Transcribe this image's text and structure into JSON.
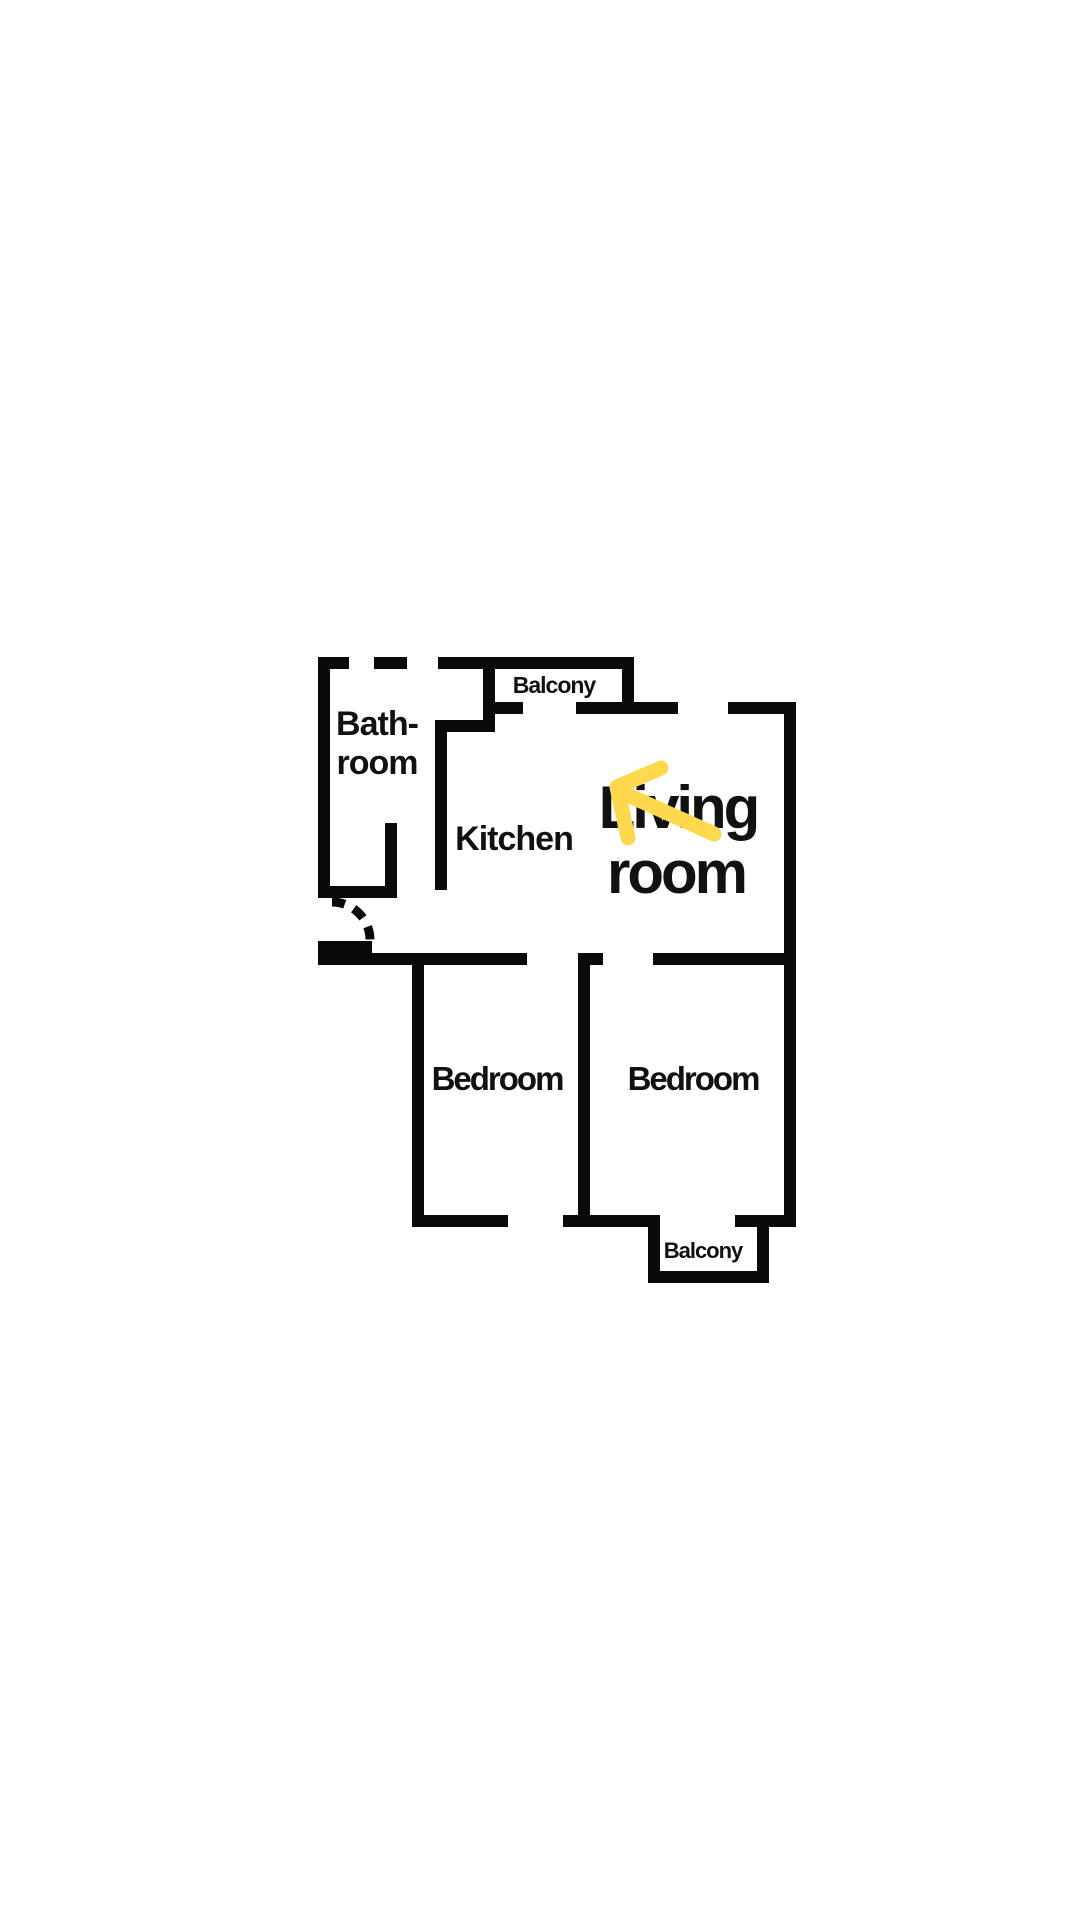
{
  "page": {
    "background": "#ffffff",
    "width": 1080,
    "height": 1920
  },
  "floorplan": {
    "wall_color": "#0a0a0a",
    "text_color": "#111111",
    "arrow_color": "#FFD84E",
    "wall_thickness": 12,
    "walls": [
      {
        "x": 318,
        "y": 657,
        "w": 31,
        "h": 12
      },
      {
        "x": 374,
        "y": 657,
        "w": 33,
        "h": 12
      },
      {
        "x": 438,
        "y": 657,
        "w": 196,
        "h": 12
      },
      {
        "x": 495,
        "y": 702,
        "w": 28,
        "h": 12
      },
      {
        "x": 576,
        "y": 702,
        "w": 102,
        "h": 12
      },
      {
        "x": 728,
        "y": 702,
        "w": 68,
        "h": 12
      },
      {
        "x": 435,
        "y": 720,
        "w": 60,
        "h": 12
      },
      {
        "x": 318,
        "y": 886,
        "w": 79,
        "h": 12
      },
      {
        "x": 318,
        "y": 941,
        "w": 54,
        "h": 12
      },
      {
        "x": 318,
        "y": 953,
        "w": 209,
        "h": 12
      },
      {
        "x": 578,
        "y": 953,
        "w": 25,
        "h": 12
      },
      {
        "x": 653,
        "y": 953,
        "w": 143,
        "h": 12
      },
      {
        "x": 412,
        "y": 1215,
        "w": 96,
        "h": 12
      },
      {
        "x": 563,
        "y": 1215,
        "w": 97,
        "h": 12
      },
      {
        "x": 735,
        "y": 1215,
        "w": 61,
        "h": 12
      },
      {
        "x": 648,
        "y": 1271,
        "w": 121,
        "h": 12
      },
      {
        "x": 318,
        "y": 657,
        "w": 12,
        "h": 241
      },
      {
        "x": 318,
        "y": 941,
        "w": 12,
        "h": 24
      },
      {
        "x": 385,
        "y": 823,
        "w": 12,
        "h": 75
      },
      {
        "x": 435,
        "y": 720,
        "w": 12,
        "h": 170
      },
      {
        "x": 483,
        "y": 657,
        "w": 12,
        "h": 75
      },
      {
        "x": 622,
        "y": 657,
        "w": 12,
        "h": 57
      },
      {
        "x": 784,
        "y": 702,
        "w": 12,
        "h": 525
      },
      {
        "x": 412,
        "y": 965,
        "w": 12,
        "h": 262
      },
      {
        "x": 578,
        "y": 965,
        "w": 12,
        "h": 262
      },
      {
        "x": 648,
        "y": 1227,
        "w": 12,
        "h": 56
      },
      {
        "x": 757,
        "y": 1227,
        "w": 12,
        "h": 56
      }
    ],
    "door_arc": {
      "d": "M 332 902 A 38 38 0 0 1 370 940",
      "dash": "13 10",
      "stroke_width": 9
    },
    "arrow": {
      "shaft": "621,792 714,834",
      "head": "661,768 617,787 628,838",
      "stroke_width": 15
    },
    "labels": [
      {
        "id": "bathroom-line-1",
        "text": "Bath-",
        "x": 377,
        "y": 735,
        "size": 34,
        "spacing": -1
      },
      {
        "id": "bathroom-line-2",
        "text": "room",
        "x": 377,
        "y": 774,
        "size": 34,
        "spacing": -1
      },
      {
        "id": "balcony-top",
        "text": "Balcony",
        "x": 554,
        "y": 693,
        "size": 23,
        "spacing": -1
      },
      {
        "id": "kitchen",
        "text": "Kitchen",
        "x": 514,
        "y": 850,
        "size": 34,
        "spacing": -1
      },
      {
        "id": "living-room-line-1",
        "text": "Living",
        "x": 678,
        "y": 828,
        "size": 60,
        "spacing": -3
      },
      {
        "id": "living-room-line-2",
        "text": "room",
        "x": 676,
        "y": 893,
        "size": 60,
        "spacing": -3
      },
      {
        "id": "bedroom-left",
        "text": "Bedroom",
        "x": 497,
        "y": 1090,
        "size": 33,
        "spacing": -2
      },
      {
        "id": "bedroom-right",
        "text": "Bedroom",
        "x": 693,
        "y": 1090,
        "size": 33,
        "spacing": -2
      },
      {
        "id": "balcony-bottom",
        "text": "Balcony",
        "x": 703,
        "y": 1258,
        "size": 22,
        "spacing": -1
      }
    ]
  }
}
